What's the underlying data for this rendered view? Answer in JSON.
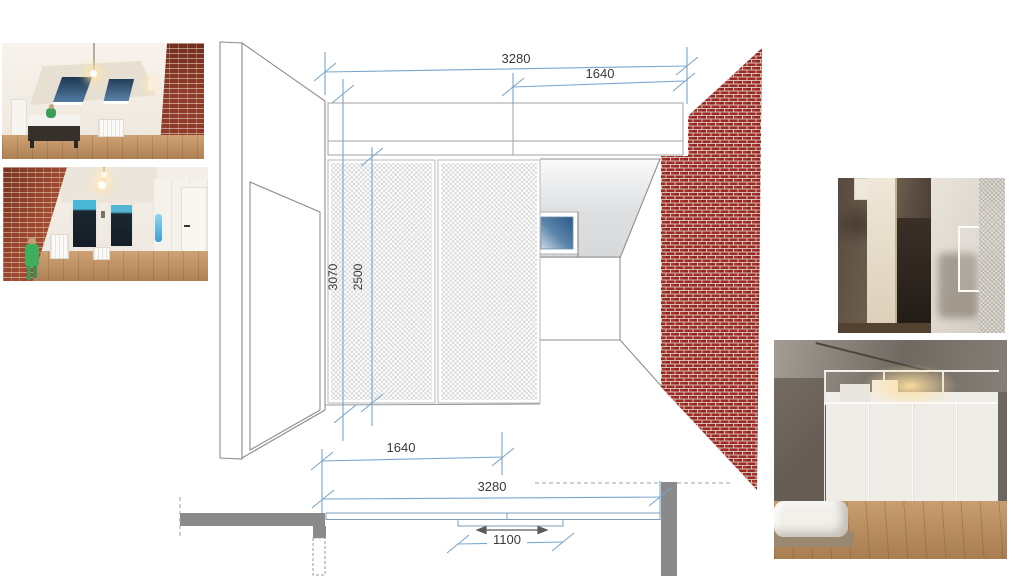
{
  "drawing": {
    "elevation": {
      "dim_total_width": "3280",
      "dim_half_width": "1640",
      "dim_wall_height": "3070",
      "dim_partition_height": "2500"
    },
    "plan": {
      "dim_half_width": "1640",
      "dim_total_width": "3280",
      "dim_door_width": "1100"
    },
    "colors": {
      "dimension_blue": "#7ba6cc",
      "brick_red": "#9d2a23",
      "mortar_white": "#e6e2dd",
      "outline_gray": "#8c8c8c",
      "plan_wall_gray": "#8a8a8a",
      "window_glass_blue": "#2b5a8a"
    }
  },
  "photos": {
    "top_left": "attic-bedroom-with-brick-wall",
    "mid_left": "room-with-brick-wall-and-windows",
    "right_upper": "concrete-closet-with-mesh-screen",
    "right_lower": "bedroom-with-frosted-glass-partition"
  }
}
